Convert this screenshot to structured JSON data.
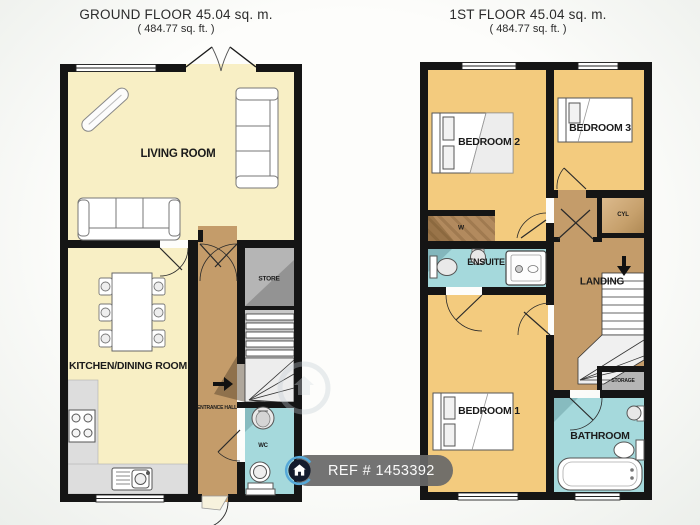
{
  "ground_floor": {
    "title": "GROUND FLOOR 45.04 sq. m.",
    "subtitle": "( 484.77 sq. ft. )",
    "labels": {
      "living_room": "LIVING ROOM",
      "kitchen_dining": "KITCHEN/DINING ROOM",
      "entrance_hall": "ENTRANCE HALL",
      "store": "STORE",
      "wc": "WC"
    }
  },
  "first_floor": {
    "title": "1ST FLOOR 45.04 sq. m.",
    "subtitle": "( 484.77 sq. ft. )",
    "labels": {
      "bedroom1": "BEDROOM 1",
      "bedroom2": "BEDROOM 2",
      "bedroom3": "BEDROOM 3",
      "ensuite": "ENSUITE",
      "landing": "LANDING",
      "bathroom": "BATHROOM",
      "storage": "STORAGE",
      "cyl": "CYL",
      "wardrobe": "W"
    }
  },
  "badge": {
    "ref_label": "REF # 1453392"
  },
  "colors": {
    "wall": "#151515",
    "cream_floor": "#f8efc5",
    "orange_floor": "#f3cb7e",
    "hall_brown": "#c49c6a",
    "wardrobe_brown": "#b28a5e",
    "cyl_tan": "#d0ab77",
    "wet_room_cyan": "#a5d9dc",
    "store_gray": "#b5b5b5",
    "counter_gray": "#dddddd",
    "badge_bg": "#686868",
    "logo_navy": "#131b2d",
    "logo_blue": "#55a8d8"
  }
}
